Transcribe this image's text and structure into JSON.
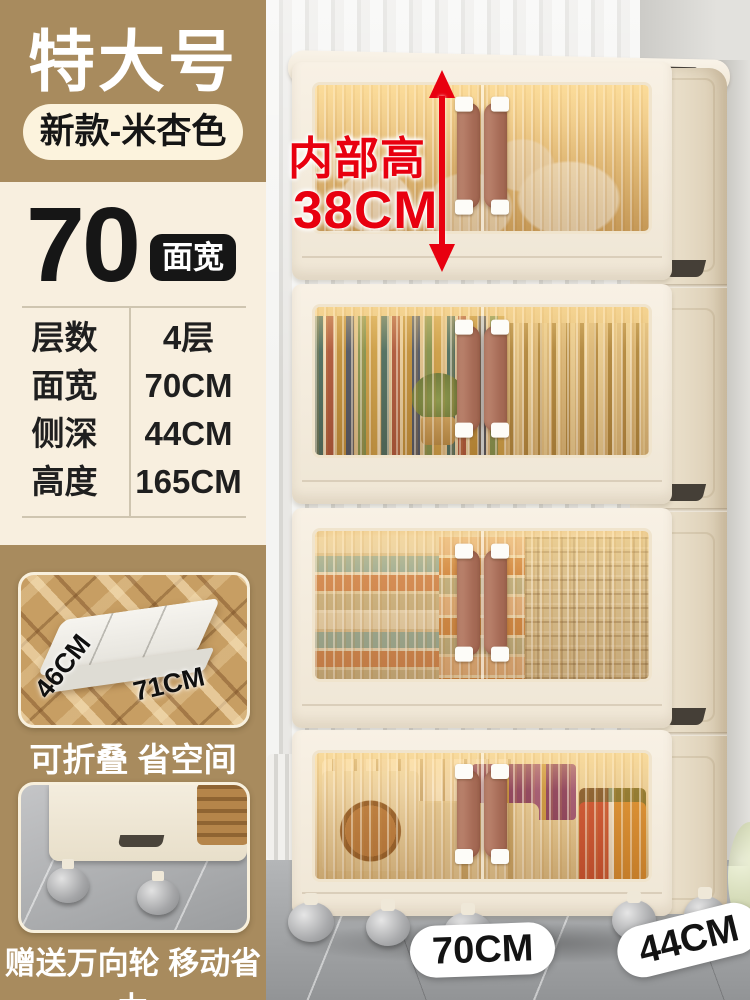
{
  "header": {
    "size_badge": "特大号",
    "variant_badge": "新款-米杏色"
  },
  "width_feature": {
    "value": "70",
    "unit_badge": "面宽"
  },
  "specs": {
    "rows": [
      {
        "label": "层数",
        "value": "4层"
      },
      {
        "label": "面宽",
        "value": "70CM"
      },
      {
        "label": "侧深",
        "value": "44CM"
      },
      {
        "label": "高度",
        "value": "165CM"
      }
    ]
  },
  "folded_card": {
    "depth_label": "46CM",
    "width_label": "71CM",
    "caption": "可折叠 省空间"
  },
  "wheels_card": {
    "caption": "赠送万向轮 移动省力"
  },
  "photo": {
    "internal_height_line1": "内部高",
    "internal_height_line2": "38CM",
    "width_dim": "70CM",
    "depth_dim": "44CM",
    "tier_count": "4"
  },
  "colors": {
    "tan": "#a88b5e",
    "cream_panel": "#f8efdf",
    "pill_cream": "#fcf3dd",
    "accent_red": "#e8000f",
    "badge_black": "#161616",
    "cabinet_body": "#f3ecdf",
    "window_amber": "#e3bc77",
    "handle_brown": "#a66b56"
  }
}
